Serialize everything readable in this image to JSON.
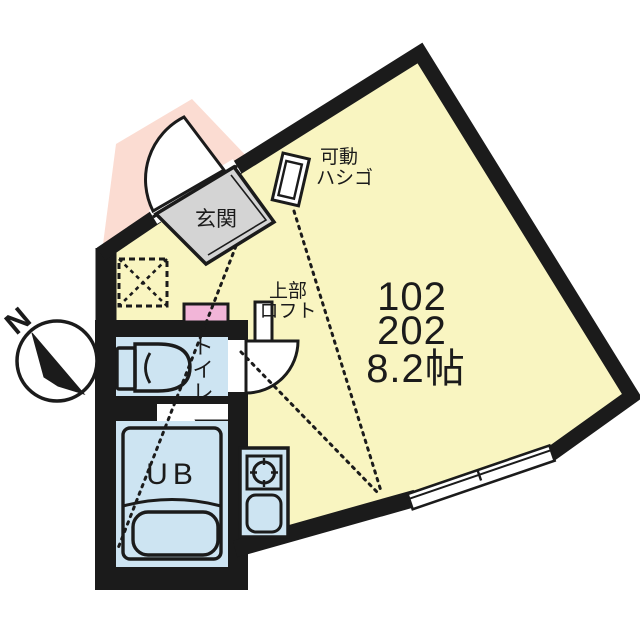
{
  "plan": {
    "unit_numbers": [
      "102",
      "202"
    ],
    "area": "8.2帖",
    "rooms": {
      "entrance_label": "玄関",
      "ladder_label": [
        "可動",
        "ハシゴ"
      ],
      "loft_label": [
        "上部",
        "ロフト"
      ],
      "toilet_label_chars": [
        "ト",
        "イ",
        "レ"
      ],
      "bath_label": "UB"
    },
    "compass": {
      "north_label": "N"
    },
    "colors": {
      "wall": "#1b1b1b",
      "room_yellow": "#f9f5c1",
      "porch_pink": "#fbdcd2",
      "water_blue": "#cde4f2",
      "counter_pink": "#f2b5d8",
      "entrance_gray": "#d4d4d4"
    }
  }
}
